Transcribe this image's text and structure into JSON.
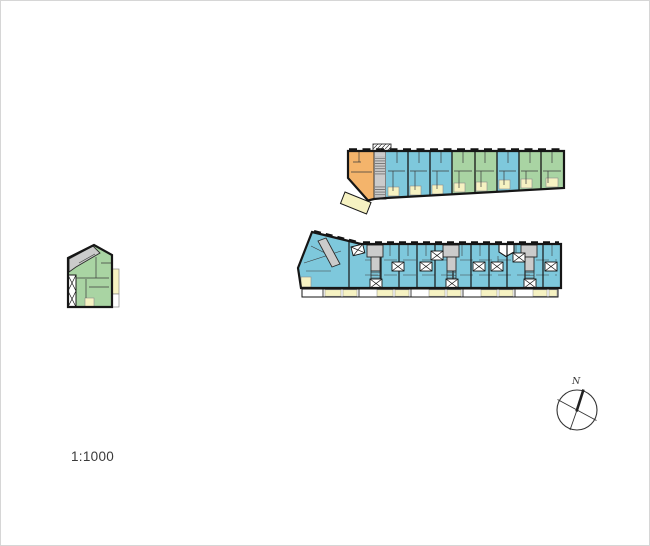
{
  "drawing": {
    "scale_label": "1:1000",
    "type": "architectural-site-floor-plan"
  },
  "compass": {
    "label": "N"
  },
  "colors": {
    "background": "#ffffff",
    "outline": "#161616",
    "interior_wall": "#3c3c3c",
    "unit_orange": "#f4b46b",
    "unit_blue": "#7ec8dc",
    "unit_green": "#a9d4a3",
    "balcony_cream": "#f6f2c2",
    "stair_gray": "#cbcbcb",
    "text": "#3a3a3a"
  }
}
